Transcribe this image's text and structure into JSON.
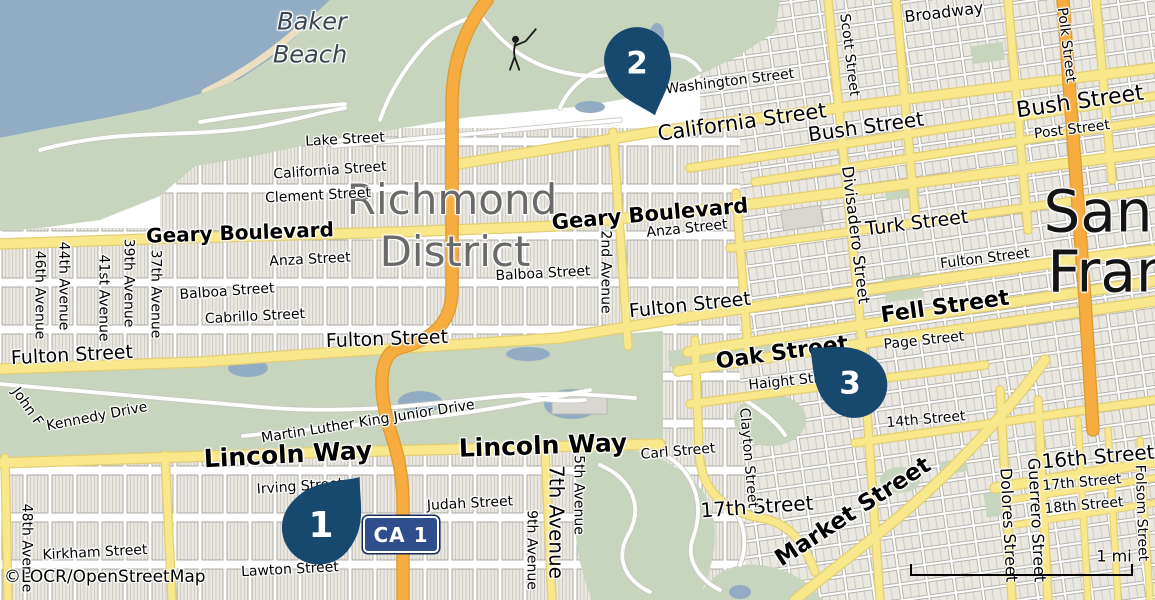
{
  "map": {
    "attribution": "©LOCR/OpenStreetMap",
    "scale_label": "1 mi",
    "shield_label": "CA 1",
    "markers": [
      {
        "label": "1"
      },
      {
        "label": "2"
      },
      {
        "label": "3"
      }
    ],
    "colors": {
      "water": "#92acc4",
      "park": "#c7d4be",
      "block": "#e9e7df",
      "bout": "#9b9b94",
      "yellow": "#f9e88b",
      "ycase": "#e2ce74",
      "orange": "#f6ac3e",
      "ocase": "#de9a2e",
      "wcase": "#c8c6bf",
      "pin": "#17496f",
      "shield": "#2f4f8c",
      "shieldoutline": "#1a2a56",
      "district": "#6a6a6a",
      "city": "#141414",
      "beach": "#3c4650"
    },
    "labels": [
      {
        "t": "Baker",
        "x": 312,
        "y": 22,
        "s": 24,
        "c": "#3c4650",
        "i": 1
      },
      {
        "t": "Beach",
        "x": 310,
        "y": 55,
        "s": 24,
        "c": "#3c4650",
        "i": 1
      },
      {
        "t": "Richmond",
        "x": 452,
        "y": 200,
        "s": 42,
        "c": "#6a6a6a"
      },
      {
        "t": "District",
        "x": 455,
        "y": 252,
        "s": 42,
        "c": "#6a6a6a"
      },
      {
        "t": "San",
        "x": 1098,
        "y": 212,
        "s": 58,
        "c": "#141414"
      },
      {
        "t": "Fran",
        "x": 1110,
        "y": 272,
        "s": 58,
        "c": "#141414"
      },
      {
        "t": "Lake Street",
        "x": 345,
        "y": 140,
        "r": -3,
        "s": 14
      },
      {
        "t": "California Street",
        "x": 330,
        "y": 171,
        "r": -4,
        "s": 14
      },
      {
        "t": "Clement Street",
        "x": 318,
        "y": 196,
        "r": -3,
        "s": 14
      },
      {
        "t": "Geary Boulevard",
        "x": 240,
        "y": 233,
        "r": -2,
        "s": 20,
        "w": 700
      },
      {
        "t": "Anza Street",
        "x": 310,
        "y": 260,
        "r": -3,
        "s": 14
      },
      {
        "t": "Balboa Street",
        "x": 227,
        "y": 292,
        "r": -4,
        "s": 14
      },
      {
        "t": "Cabrillo Street",
        "x": 255,
        "y": 317,
        "r": -3,
        "s": 14
      },
      {
        "t": "Fulton Street",
        "x": 72,
        "y": 356,
        "r": -3,
        "s": 19
      },
      {
        "t": "46th Avenue",
        "x": 39,
        "y": 295,
        "r": 90,
        "s": 14
      },
      {
        "t": "44th Avenue",
        "x": 63,
        "y": 286,
        "r": 90,
        "s": 14
      },
      {
        "t": "41st Avenue",
        "x": 103,
        "y": 298,
        "r": 90,
        "s": 14
      },
      {
        "t": "39th Avenue",
        "x": 128,
        "y": 283,
        "r": 90,
        "s": 14
      },
      {
        "t": "37th Avenue",
        "x": 155,
        "y": 294,
        "r": 90,
        "s": 14
      },
      {
        "t": "2nd Avenue",
        "x": 605,
        "y": 272,
        "r": 90,
        "s": 14
      },
      {
        "t": "Geary Boulevard",
        "x": 650,
        "y": 214,
        "r": -5,
        "s": 21,
        "w": 700
      },
      {
        "t": "Anza Street",
        "x": 687,
        "y": 229,
        "r": -6,
        "s": 14
      },
      {
        "t": "Balboa Street",
        "x": 543,
        "y": 274,
        "r": -3,
        "s": 14
      },
      {
        "t": "Fulton Street",
        "x": 387,
        "y": 340,
        "r": -2,
        "s": 19
      },
      {
        "t": "Fulton Street",
        "x": 690,
        "y": 306,
        "r": -6,
        "s": 19
      },
      {
        "t": "Fulton Street",
        "x": 985,
        "y": 259,
        "r": -7,
        "s": 14
      },
      {
        "t": "John F",
        "x": 27,
        "y": 407,
        "r": 55,
        "s": 14
      },
      {
        "t": "Kennedy Drive",
        "x": 97,
        "y": 417,
        "r": -11,
        "s": 14
      },
      {
        "t": "Martin Luther King Junior Drive",
        "x": 368,
        "y": 422,
        "r": -9,
        "s": 14
      },
      {
        "t": "Lincoln Way",
        "x": 288,
        "y": 455,
        "r": -3,
        "s": 25,
        "w": 700
      },
      {
        "t": "Lincoln Way",
        "x": 543,
        "y": 446,
        "r": -2,
        "s": 25,
        "w": 700
      },
      {
        "t": "Irving Street",
        "x": 300,
        "y": 487,
        "r": -4,
        "s": 14
      },
      {
        "t": "Judah Street",
        "x": 470,
        "y": 504,
        "r": -3,
        "s": 14
      },
      {
        "t": "Kirkham Street",
        "x": 95,
        "y": 553,
        "r": -3,
        "s": 14
      },
      {
        "t": "Lawton Street",
        "x": 290,
        "y": 570,
        "r": -3,
        "s": 14
      },
      {
        "t": "48th Avenue",
        "x": 26,
        "y": 548,
        "r": 90,
        "s": 14
      },
      {
        "t": "5th Avenue",
        "x": 578,
        "y": 495,
        "r": 90,
        "s": 14
      },
      {
        "t": "7th Avenue",
        "x": 556,
        "y": 522,
        "r": 90,
        "s": 20
      },
      {
        "t": "9th Avenue",
        "x": 531,
        "y": 550,
        "r": 90,
        "s": 14
      },
      {
        "t": "Carl Street",
        "x": 678,
        "y": 452,
        "r": -5,
        "s": 14
      },
      {
        "t": "17th Street",
        "x": 757,
        "y": 507,
        "r": -4,
        "s": 20
      },
      {
        "t": "Clayton Street",
        "x": 748,
        "y": 458,
        "r": 85,
        "s": 14
      },
      {
        "t": "Washington Street",
        "x": 730,
        "y": 82,
        "r": -7,
        "s": 14
      },
      {
        "t": "California Street",
        "x": 742,
        "y": 122,
        "r": -8,
        "s": 21
      },
      {
        "t": "Bush Street",
        "x": 866,
        "y": 127,
        "r": -8,
        "s": 20
      },
      {
        "t": "Bush Street",
        "x": 1080,
        "y": 102,
        "r": -8,
        "s": 22
      },
      {
        "t": "Post Street",
        "x": 1072,
        "y": 130,
        "r": -7,
        "s": 14
      },
      {
        "t": "Broadway",
        "x": 944,
        "y": 13,
        "r": -7,
        "s": 16
      },
      {
        "t": "Scott Street",
        "x": 849,
        "y": 55,
        "r": 83,
        "s": 14
      },
      {
        "t": "Polk Street",
        "x": 1066,
        "y": 45,
        "r": 83,
        "s": 14
      },
      {
        "t": "Divisadero Street",
        "x": 855,
        "y": 235,
        "r": 83,
        "s": 16
      },
      {
        "t": "Turk Street",
        "x": 917,
        "y": 224,
        "r": -7,
        "s": 19
      },
      {
        "t": "Fell Street",
        "x": 945,
        "y": 307,
        "r": -8,
        "s": 22,
        "w": 700
      },
      {
        "t": "Oak Street",
        "x": 782,
        "y": 353,
        "r": -8,
        "s": 22,
        "w": 700
      },
      {
        "t": "Page Street",
        "x": 924,
        "y": 341,
        "r": -6,
        "s": 14
      },
      {
        "t": "Haight Street",
        "x": 795,
        "y": 381,
        "r": -6,
        "s": 14
      },
      {
        "t": "14th Street",
        "x": 926,
        "y": 420,
        "r": -5,
        "s": 14
      },
      {
        "t": "Market Street",
        "x": 853,
        "y": 512,
        "r": -33,
        "s": 23,
        "w": 700
      },
      {
        "t": "16th Street",
        "x": 1098,
        "y": 457,
        "r": -5,
        "s": 20
      },
      {
        "t": "17th Street",
        "x": 1082,
        "y": 483,
        "r": -5,
        "s": 14
      },
      {
        "t": "18th Street",
        "x": 1084,
        "y": 506,
        "r": -5,
        "s": 14
      },
      {
        "t": "Guerrero Street",
        "x": 1036,
        "y": 520,
        "r": 87,
        "s": 16
      },
      {
        "t": "Dolores Street",
        "x": 1008,
        "y": 525,
        "r": 87,
        "s": 16
      },
      {
        "t": "Folsom Street",
        "x": 1141,
        "y": 513,
        "r": 88,
        "s": 14
      }
    ]
  }
}
